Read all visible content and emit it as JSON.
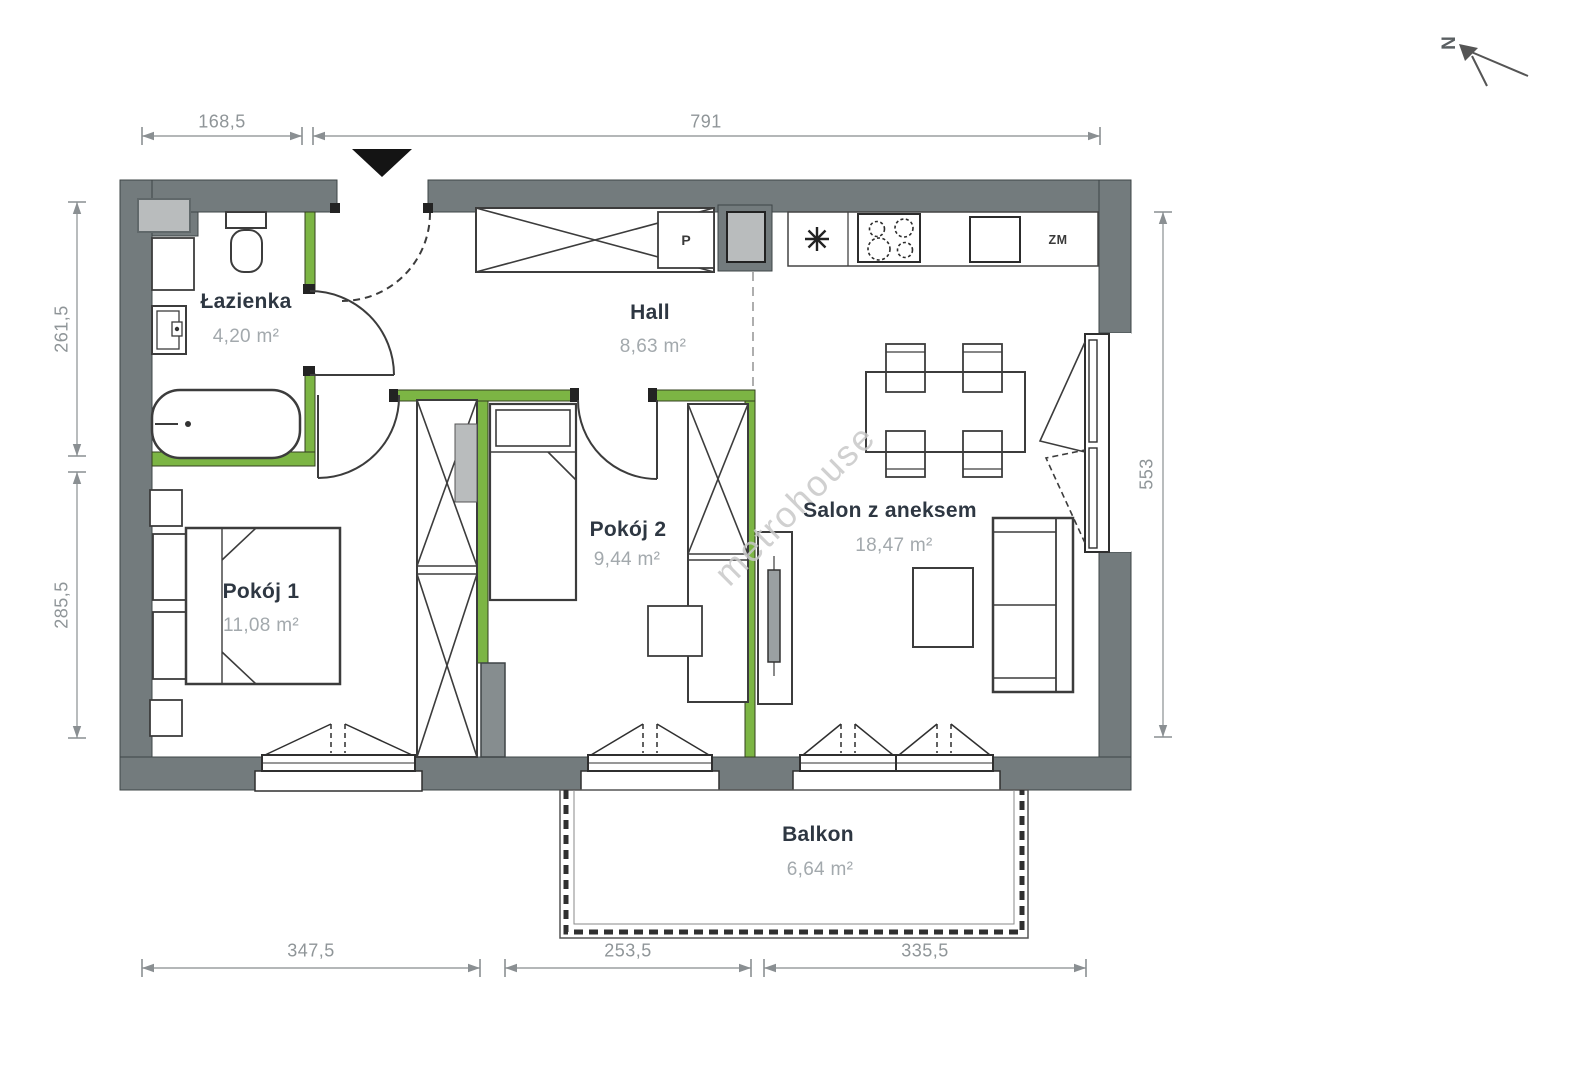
{
  "north": {
    "label": "N"
  },
  "watermark": {
    "text": "metrohouse"
  },
  "rooms": [
    {
      "name": "Łazienka",
      "area": "4,20 m²"
    },
    {
      "name": "Hall",
      "area": "8,63 m²"
    },
    {
      "name": "Pokój 1",
      "area": "11,08 m²"
    },
    {
      "name": "Pokój 2",
      "area": "9,44 m²"
    },
    {
      "name": "Salon z aneksem",
      "area": "18,47 m²"
    },
    {
      "name": "Balkon",
      "area": "6,64 m²"
    }
  ],
  "fixtures": {
    "washer_label": "P",
    "dishwasher_label": "ZM"
  },
  "dimensions": {
    "top": [
      "168,5",
      "791"
    ],
    "left": [
      "261,5",
      "285,5"
    ],
    "right": [
      "553"
    ],
    "bottom": [
      "347,5",
      "253,5",
      "335,5"
    ]
  },
  "colors": {
    "wall": "#737b7d",
    "green_wall": "#7cb544",
    "shaft": "#b9bcbd",
    "dimension_text": "#8f9598",
    "room_name": "#2e3742",
    "room_area": "#a3a9ad",
    "watermark": "#c8c8c8"
  }
}
